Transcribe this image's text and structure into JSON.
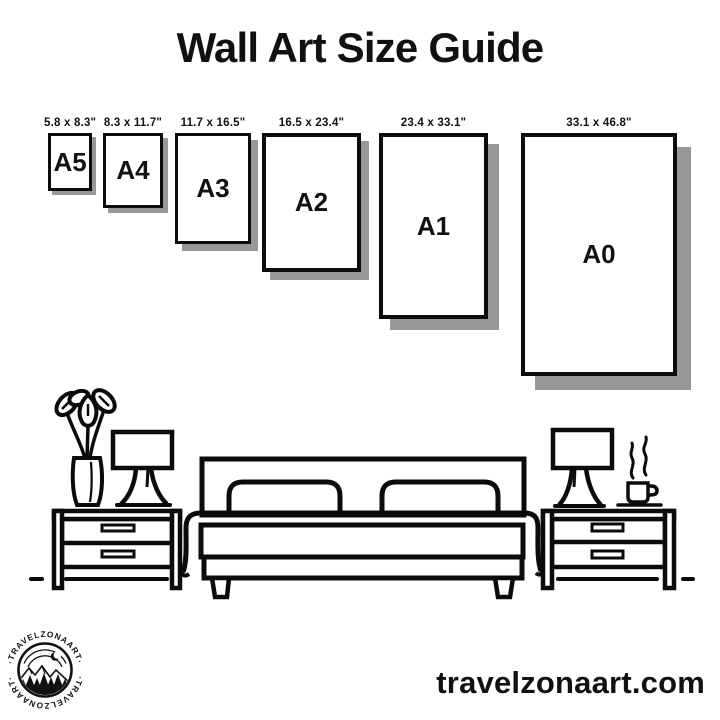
{
  "title": "Wall Art Size Guide",
  "website": "travelzonaart.com",
  "logo": {
    "brand": "TRAVELZONAART",
    "ring_text": "·TRAVELZONAART·"
  },
  "sizes": [
    {
      "name": "A5",
      "dims": "5.8 x 8.3\""
    },
    {
      "name": "A4",
      "dims": "8.3 x 11.7\""
    },
    {
      "name": "A3",
      "dims": "11.7 x 16.5\""
    },
    {
      "name": "A2",
      "dims": "16.5 x 23.4\""
    },
    {
      "name": "A1",
      "dims": "23.4 x 33.1\""
    },
    {
      "name": "A0",
      "dims": "33.1 x 46.8\""
    }
  ],
  "scene": {
    "description": "line-art bedroom: double bed with two pillows between two nightstands, plant vase and lamp on left nightstand, lamp and steaming coffee cup on right nightstand"
  },
  "colors": {
    "ink": "#0b0b0b",
    "frame_border": "#0c0c0c",
    "shadow": "#989898",
    "background": "#ffffff"
  }
}
